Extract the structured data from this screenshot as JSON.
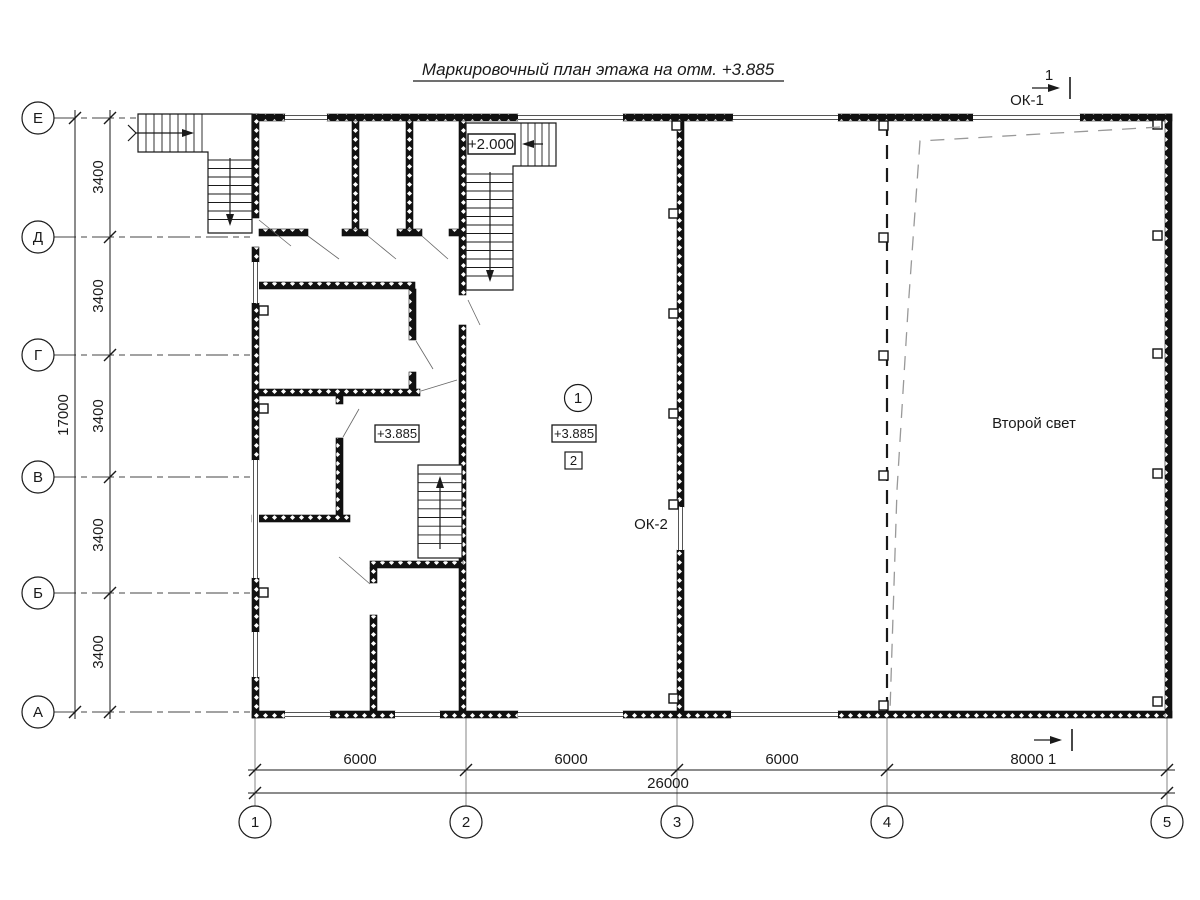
{
  "title": "Маркировочный план этажа на отм. +3.885",
  "axis_rows": [
    "Е",
    "Д",
    "Г",
    "В",
    "Б",
    "А"
  ],
  "axis_cols": [
    "1",
    "2",
    "3",
    "4",
    "5"
  ],
  "dims": {
    "row_spacing": [
      "3400",
      "3400",
      "3400",
      "3400",
      "3400"
    ],
    "row_total": "17000",
    "col_spacing": [
      "6000",
      "6000",
      "6000",
      "8000"
    ],
    "col_total": "26000"
  },
  "marks": {
    "ok1": "ОК-1",
    "ok2": "ОК-2",
    "second_light": "Второй свет",
    "level_2000": "+2.000",
    "level_3885_a": "+3.885",
    "level_3885_b": "+3.885",
    "zone_circle": "1",
    "zone_square": "2",
    "section_top": "1",
    "section_bottom": "1"
  },
  "colors": {
    "line": "#1a1a1a",
    "window_line": "#555555",
    "void_dash": "#999999",
    "background": "#ffffff"
  }
}
